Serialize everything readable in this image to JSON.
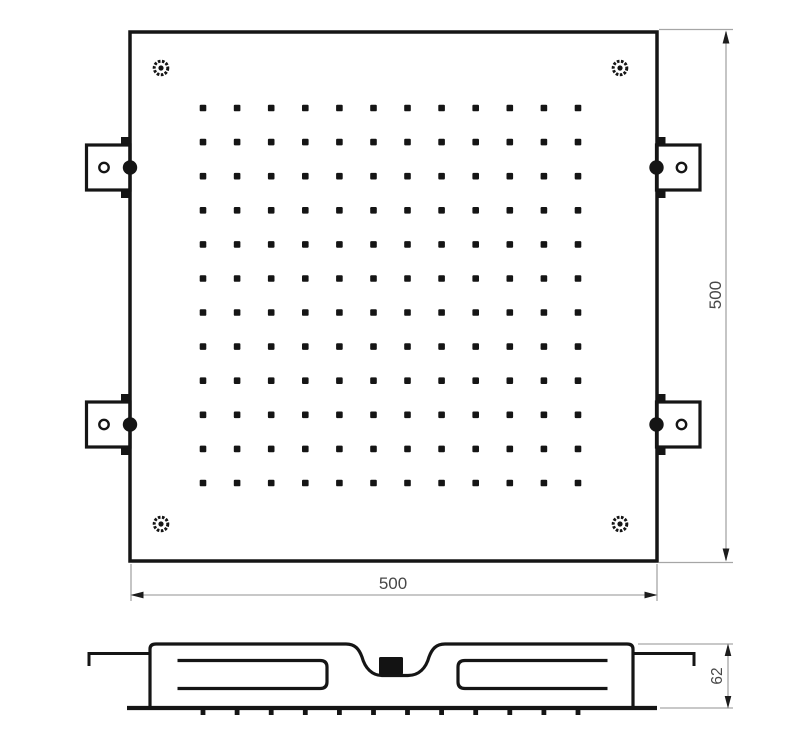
{
  "drawing": {
    "background_color": "#ffffff",
    "outline_color": "#151515",
    "dim_line_color": "#a6a6a6",
    "dim_arrow_color": "#1c1c1c",
    "dim_text_color": "#474747"
  },
  "top_view": {
    "nozzle_grid": {
      "rows": 12,
      "cols": 12
    },
    "corner_screw_count": 4,
    "mounting_bracket_count": 4
  },
  "side_view": {
    "nozzle_tick_count": 12,
    "has_center_inlet": true
  },
  "dimensions": {
    "width_label": "500",
    "height_label": "500",
    "depth_label": "62"
  }
}
